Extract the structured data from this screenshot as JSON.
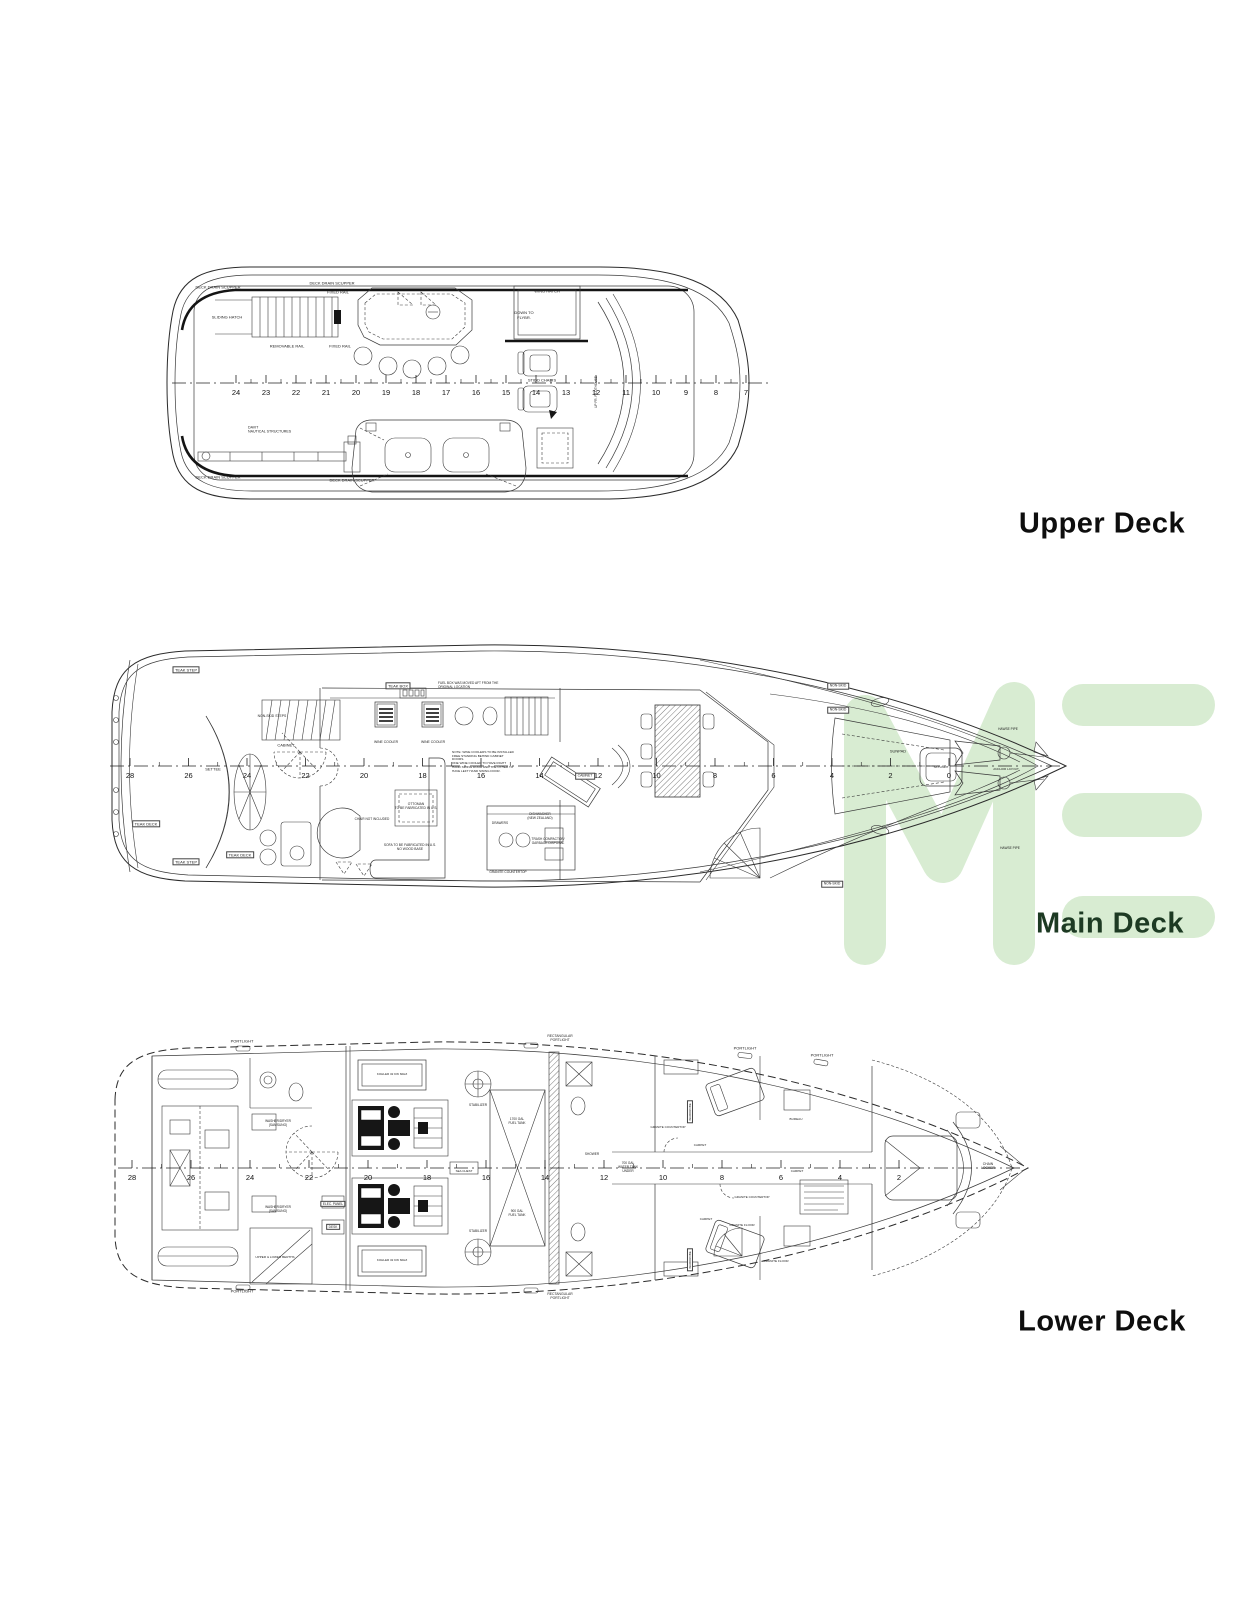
{
  "page": {
    "background": "#ffffff"
  },
  "watermark": {
    "name": "ME-logo-watermark",
    "color": "#d8ecd2"
  },
  "decks": [
    {
      "id": "upper",
      "title": "Upper Deck",
      "title_color": "#0e0e0e",
      "ruler": {
        "labels": [
          "24",
          "23",
          "22",
          "21",
          "20",
          "19",
          "18",
          "17",
          "16",
          "15",
          "14",
          "13",
          "12",
          "11",
          "10",
          "9",
          "8",
          "7"
        ],
        "x0": 236,
        "dx": 30,
        "y": 383
      }
    },
    {
      "id": "main",
      "title": "Main Deck",
      "title_color": "#1d3a23",
      "ruler": {
        "labels": [
          "28",
          "26",
          "24",
          "22",
          "20",
          "18",
          "16",
          "14",
          "12",
          "10",
          "8",
          "6",
          "4",
          "2",
          "0"
        ],
        "x0": 130,
        "dx": 58.5,
        "y": 766
      }
    },
    {
      "id": "lower",
      "title": "Lower Deck",
      "title_color": "#0e0e0e",
      "ruler": {
        "labels": [
          "28",
          "26",
          "24",
          "22",
          "20",
          "18",
          "16",
          "14",
          "12",
          "10",
          "8",
          "6",
          "4",
          "2"
        ],
        "x0": 132,
        "dx": 59,
        "y": 1168
      }
    }
  ],
  "annotations": [
    {
      "deck": "upper",
      "text": "DECK DRAIN SCUPPER",
      "x": 218,
      "y": 288
    },
    {
      "deck": "upper",
      "text": "DECK DRAIN SCUPPER",
      "x": 332,
      "y": 284
    },
    {
      "deck": "upper",
      "text": "FIXED RAIL",
      "x": 338,
      "y": 293
    },
    {
      "deck": "upper",
      "text": "SLIDING HATCH",
      "x": 227,
      "y": 318
    },
    {
      "deck": "upper",
      "text": "REMOVABLE RAIL",
      "x": 287,
      "y": 347
    },
    {
      "deck": "upper",
      "text": "FIXED RAIL",
      "x": 340,
      "y": 347
    },
    {
      "deck": "upper",
      "text": "WING HATCH",
      "x": 547,
      "y": 292
    },
    {
      "deck": "upper",
      "text": "DOWN TO\nFLYBR.",
      "x": 524,
      "y": 316
    },
    {
      "deck": "upper",
      "text": "STIDD CHAIRS",
      "x": 542,
      "y": 381
    },
    {
      "deck": "upper",
      "text": "UP FR. PILOTHOUSE",
      "x": 597,
      "y": 392,
      "rot": true,
      "size": 3.2
    },
    {
      "deck": "upper",
      "text": "DAVIT\nNAUTICAL STRUCTURES",
      "x": 248,
      "y": 430,
      "align": "l",
      "size": 3.6
    },
    {
      "deck": "upper",
      "text": "DECK DRAIN SCUPPER",
      "x": 218,
      "y": 478
    },
    {
      "deck": "upper",
      "text": "DECK DRAIN SCUPPER",
      "x": 352,
      "y": 481
    },
    {
      "deck": "main",
      "text": "TEAK STEP",
      "x": 186,
      "y": 670,
      "boxed": true
    },
    {
      "deck": "main",
      "text": "TEAK STEP",
      "x": 186,
      "y": 862,
      "boxed": true
    },
    {
      "deck": "main",
      "text": "TEAK DECK",
      "x": 146,
      "y": 824,
      "boxed": true
    },
    {
      "deck": "main",
      "text": "TEAK DECK",
      "x": 240,
      "y": 855,
      "boxed": true
    },
    {
      "deck": "main",
      "text": "TEAK BOX",
      "x": 398,
      "y": 686,
      "boxed": true
    },
    {
      "deck": "main",
      "text": "FUEL BOX WAS MOVED AFT FROM THE\nORIGINAL LOCATION",
      "x": 438,
      "y": 686,
      "align": "l",
      "size": 3.2
    },
    {
      "deck": "main",
      "text": "NON-SKID STEPS",
      "x": 272,
      "y": 716,
      "size": 3.4
    },
    {
      "deck": "main",
      "text": "CABINET",
      "x": 286,
      "y": 746
    },
    {
      "deck": "main",
      "text": "SETTEE",
      "x": 213,
      "y": 770
    },
    {
      "deck": "main",
      "text": "WINE COOLER",
      "x": 386,
      "y": 742,
      "size": 3.4
    },
    {
      "deck": "main",
      "text": "WINE COOLER",
      "x": 433,
      "y": 742,
      "size": 3.4
    },
    {
      "deck": "main",
      "text": "NOTE: WINE COOLERS TO BE INSTALLED\nFREE STANDING BEHIND CABINET\nDOORS.\nONE WINE COOLER TO HAVE RIGHT\nHAND SWING DOOR AND THE OTHER TO\nHAVE LEFT HAND SWING DOOR.",
      "x": 452,
      "y": 762,
      "align": "l",
      "size": 3.1
    },
    {
      "deck": "main",
      "text": "OTTOMAN\nTO BE FABRICATED IN U.S.",
      "x": 416,
      "y": 807,
      "size": 3.3
    },
    {
      "deck": "main",
      "text": "SOFA TO BE FABRICATED IN U.S.\nNO WOOD BASE",
      "x": 410,
      "y": 848,
      "size": 3.3
    },
    {
      "deck": "main",
      "text": "CHAIR NOT INCLUDED",
      "x": 372,
      "y": 820,
      "size": 3.2
    },
    {
      "deck": "main",
      "text": "DRAWERS",
      "x": 500,
      "y": 824,
      "size": 3.2
    },
    {
      "deck": "main",
      "text": "DISHWASHER\n(NEW ZEALAND)",
      "x": 540,
      "y": 817,
      "size": 3.2
    },
    {
      "deck": "main",
      "text": "TRASH COMPACTOR/\nGARBAGE DISPOSAL",
      "x": 548,
      "y": 842,
      "size": 3.2
    },
    {
      "deck": "main",
      "text": "GRANITE COUNTERTOP",
      "x": 508,
      "y": 873,
      "size": 3.2
    },
    {
      "deck": "main",
      "text": "CABINET",
      "x": 585,
      "y": 776,
      "boxed": true,
      "size": 3.4
    },
    {
      "deck": "main",
      "text": "SUNPAD",
      "x": 898,
      "y": 752
    },
    {
      "deck": "main",
      "text": "SKYLIGHT",
      "x": 941,
      "y": 768,
      "size": 3
    },
    {
      "deck": "main",
      "text": "ANCHOR LAYOUT",
      "x": 1006,
      "y": 770,
      "size": 3
    },
    {
      "deck": "main",
      "text": "HAWSE PIPE",
      "x": 1008,
      "y": 730,
      "size": 3.2
    },
    {
      "deck": "main",
      "text": "HAWSE PIPE",
      "x": 1010,
      "y": 849,
      "size": 3.2
    },
    {
      "deck": "main",
      "text": "NON-SKID",
      "x": 838,
      "y": 686,
      "boxed": true,
      "size": 3.4
    },
    {
      "deck": "main",
      "text": "NON-SKID",
      "x": 838,
      "y": 710,
      "boxed": true,
      "size": 3.4
    },
    {
      "deck": "main",
      "text": "NON-SKID",
      "x": 832,
      "y": 884,
      "boxed": true,
      "size": 3.4
    },
    {
      "deck": "lower",
      "text": "PORTLIGHT",
      "x": 242,
      "y": 1042
    },
    {
      "deck": "lower",
      "text": "RECTANGULAR\nPORTLIGHT",
      "x": 560,
      "y": 1038,
      "size": 3.4
    },
    {
      "deck": "lower",
      "text": "PORTLIGHT",
      "x": 745,
      "y": 1049
    },
    {
      "deck": "lower",
      "text": "PORTLIGHT",
      "x": 822,
      "y": 1056
    },
    {
      "deck": "lower",
      "text": "PORTLIGHT",
      "x": 242,
      "y": 1292
    },
    {
      "deck": "lower",
      "text": "RECTANGULAR\nPORTLIGHT",
      "x": 560,
      "y": 1296,
      "size": 3.4
    },
    {
      "deck": "lower",
      "text": "KOHLER 32 KW 60HZ",
      "x": 392,
      "y": 1075,
      "size": 3
    },
    {
      "deck": "lower",
      "text": "KOHLER 32 KW 60HZ",
      "x": 392,
      "y": 1261,
      "size": 3
    },
    {
      "deck": "lower",
      "text": "STABILIZER",
      "x": 478,
      "y": 1106,
      "size": 3.2
    },
    {
      "deck": "lower",
      "text": "STABILIZER",
      "x": 478,
      "y": 1232,
      "size": 3.2
    },
    {
      "deck": "lower",
      "text": "1700 GAL\nFUEL TANK",
      "x": 517,
      "y": 1122,
      "size": 3.2
    },
    {
      "deck": "lower",
      "text": "900 GAL\nFUEL TANK",
      "x": 517,
      "y": 1214,
      "size": 3.2
    },
    {
      "deck": "lower",
      "text": "SEA CHEST",
      "x": 464,
      "y": 1172,
      "size": 3
    },
    {
      "deck": "lower",
      "text": "WASHER/DRYER\n(SAMSUNG)",
      "x": 278,
      "y": 1124,
      "size": 3.2
    },
    {
      "deck": "lower",
      "text": "WASHER/DRYER\n(SAMSUNG)",
      "x": 278,
      "y": 1210,
      "size": 3.2
    },
    {
      "deck": "lower",
      "text": "UPPER & LOWER BERTHS",
      "x": 275,
      "y": 1258,
      "size": 3.1
    },
    {
      "deck": "lower",
      "text": "ELEC. PANEL",
      "x": 333,
      "y": 1204,
      "boxed": true,
      "size": 3.2
    },
    {
      "deck": "lower",
      "text": "DESK",
      "x": 333,
      "y": 1227,
      "boxed": true,
      "size": 3.2
    },
    {
      "deck": "lower",
      "text": "SHOWER",
      "x": 592,
      "y": 1155,
      "size": 3.2
    },
    {
      "deck": "lower",
      "text": "700 GAL\nWATER TANK\nUNDER",
      "x": 628,
      "y": 1168,
      "size": 3.2
    },
    {
      "deck": "lower",
      "text": "GRANITE COUNTERTOP",
      "x": 668,
      "y": 1128,
      "size": 3
    },
    {
      "deck": "lower",
      "text": "GRANITE COUNTERTOP",
      "x": 752,
      "y": 1198,
      "size": 3
    },
    {
      "deck": "lower",
      "text": "GRANITE FLOOR",
      "x": 742,
      "y": 1226,
      "size": 3.1
    },
    {
      "deck": "lower",
      "text": "GRANITE FLOOR",
      "x": 776,
      "y": 1262,
      "size": 3.1
    },
    {
      "deck": "lower",
      "text": "CARPET",
      "x": 700,
      "y": 1146,
      "size": 3.1
    },
    {
      "deck": "lower",
      "text": "CARPET",
      "x": 797,
      "y": 1172,
      "size": 3.1
    },
    {
      "deck": "lower",
      "text": "CARPET",
      "x": 706,
      "y": 1220,
      "size": 3.1
    },
    {
      "deck": "lower",
      "text": "BUREAU",
      "x": 796,
      "y": 1120,
      "size": 3.1
    },
    {
      "deck": "lower",
      "text": "WARDROBE",
      "x": 690,
      "y": 1112,
      "boxed": true,
      "rot": true,
      "size": 3
    },
    {
      "deck": "lower",
      "text": "WARDROBE",
      "x": 690,
      "y": 1260,
      "boxed": true,
      "rot": true,
      "size": 3
    },
    {
      "deck": "lower",
      "text": "CHAIN\nLOCKER",
      "x": 988,
      "y": 1166,
      "size": 3.4
    }
  ]
}
